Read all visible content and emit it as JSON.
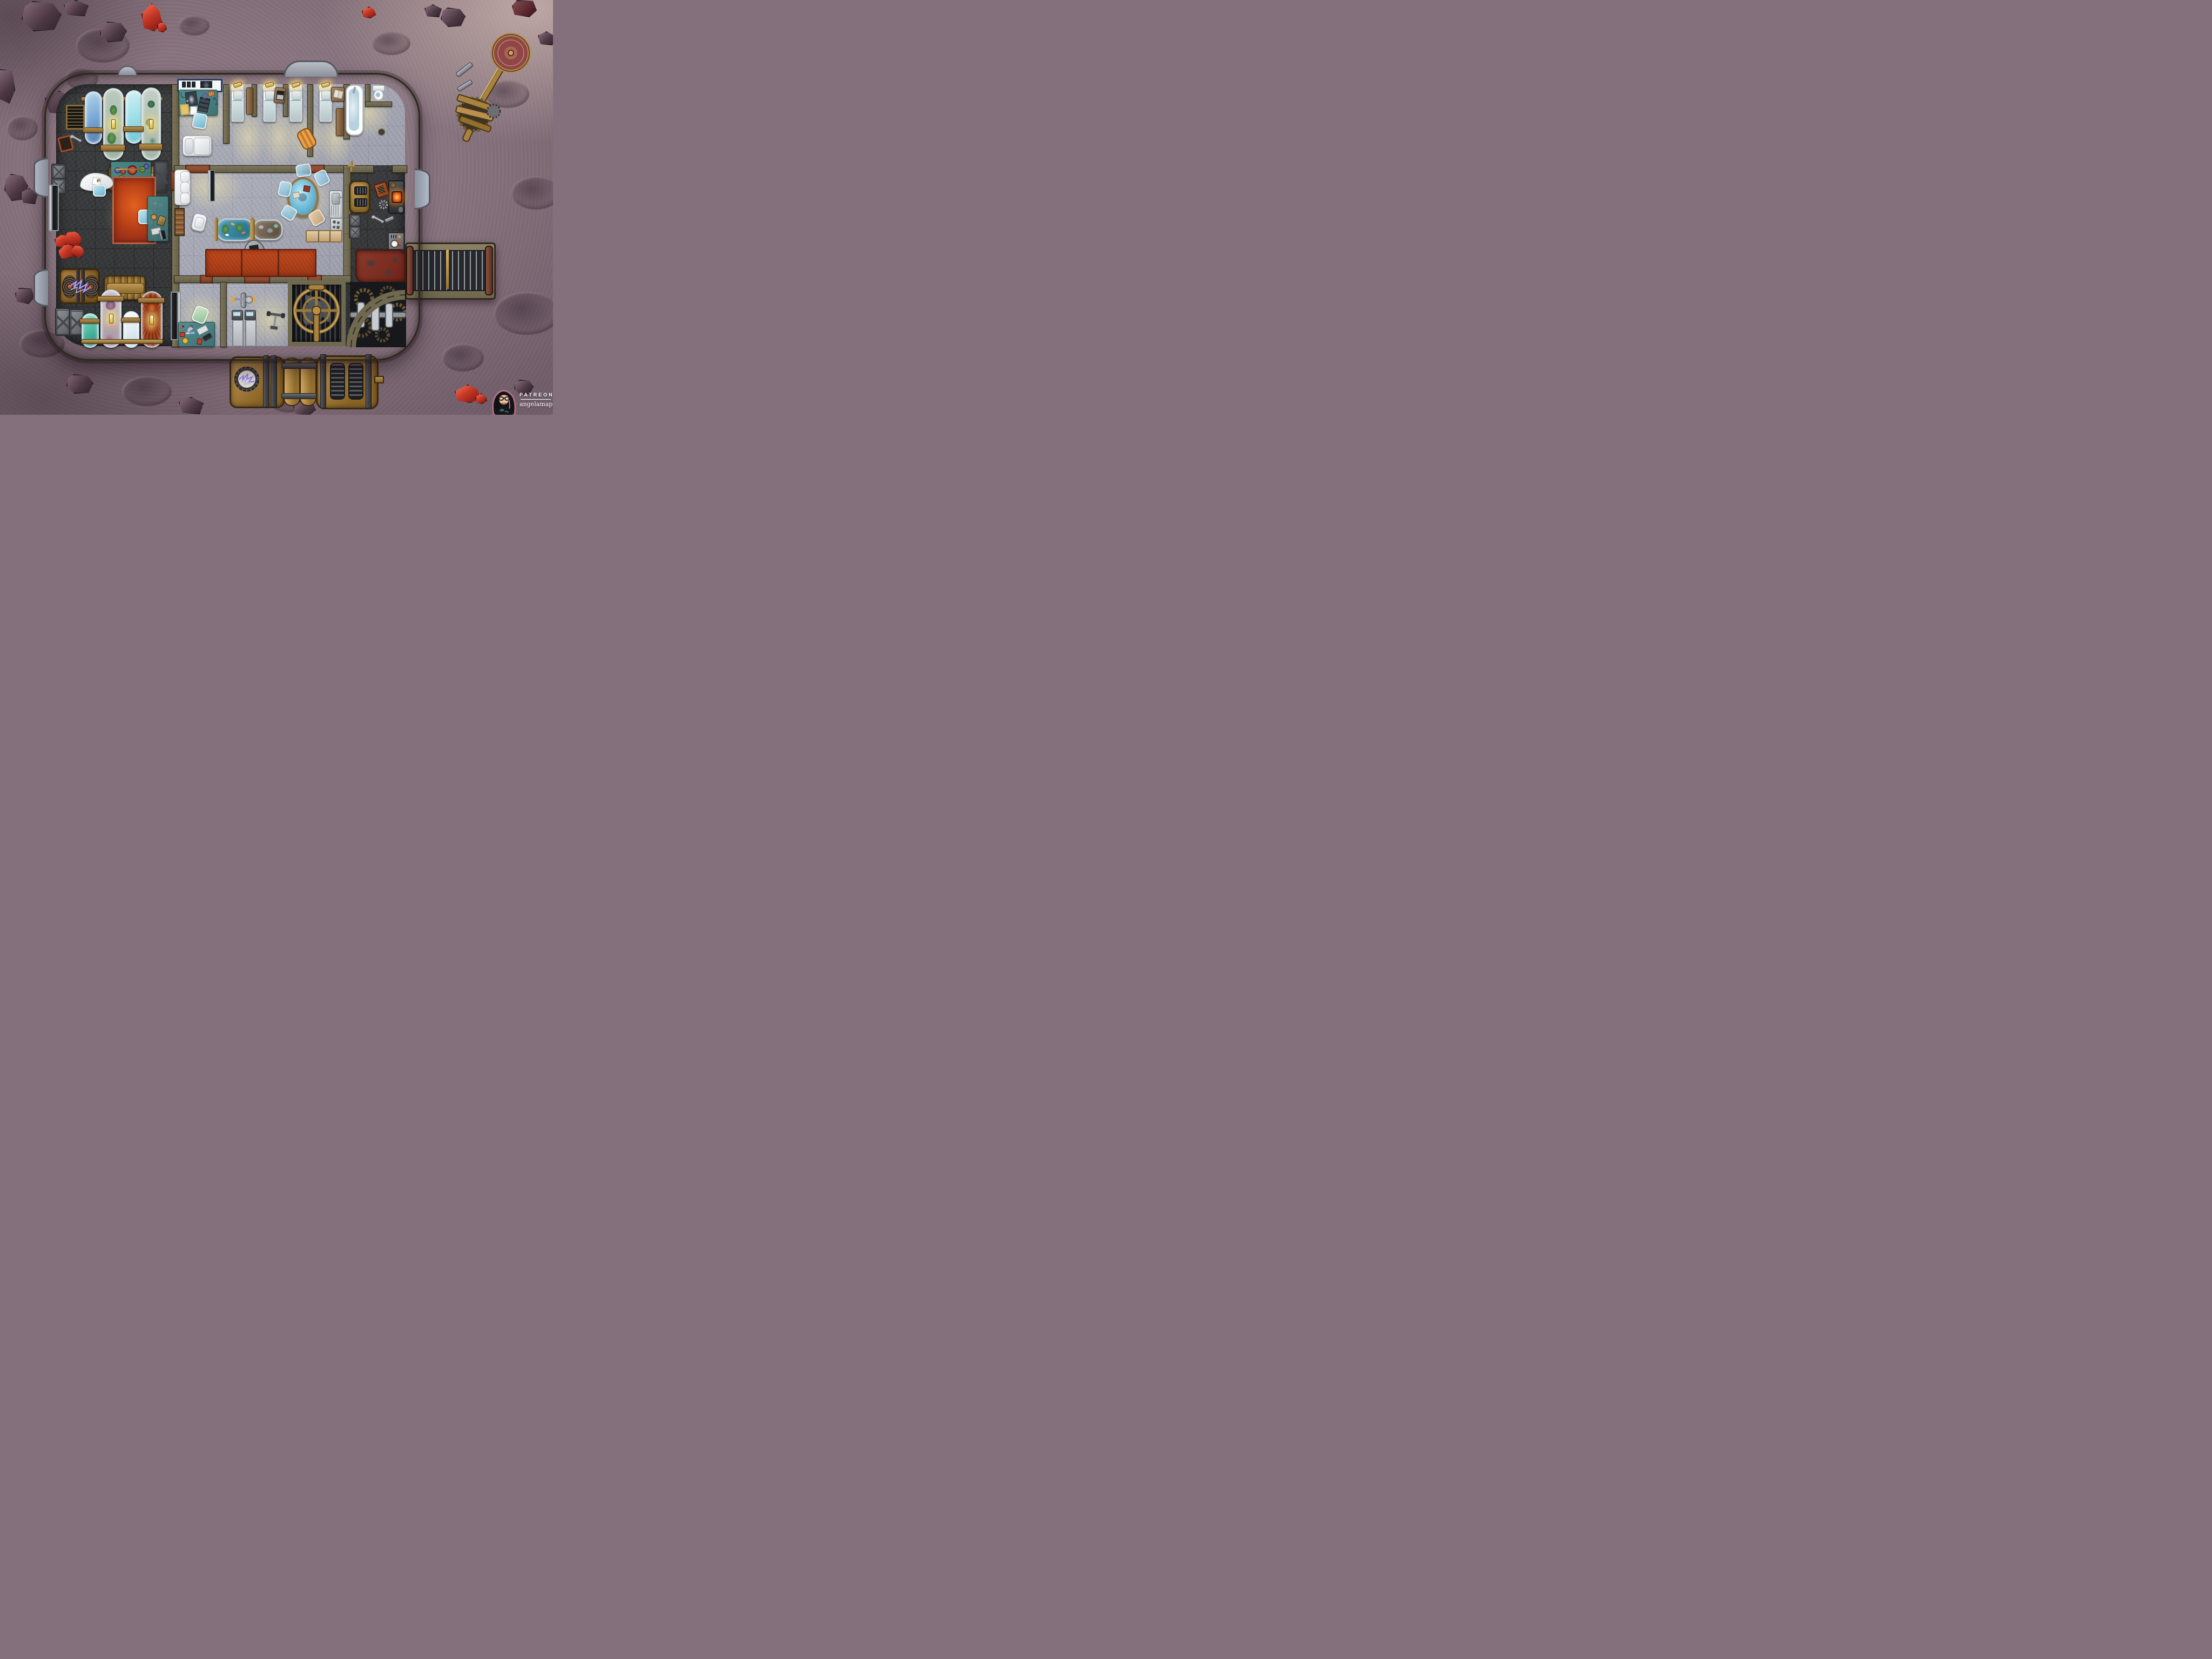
{
  "attribution": {
    "platform_label": "PATREON",
    "creator_handle": "angelamaps",
    "avatar_description": "illustrated woman, long black hair with pink streaks, glasses, black t-shirt, pink outline"
  },
  "palette": {
    "moon": "#9a8590",
    "moon_dark": "#6d5b67",
    "moon_light": "#e9d2c6",
    "wall": "#7b745a",
    "wall_dark": "#322d20",
    "floor_dark": "#3a3c3d",
    "floor_light": "#a7a9b4",
    "brass": "#a8823f",
    "brass_light": "#caa35e",
    "brass_dark": "#4a3413",
    "teal_desk": "#44807f",
    "rug_red": "#c04a1f",
    "rug_worn": "#7e2f23",
    "door_mat": "#8d4a33",
    "glow": "#f6e9b5",
    "water_blue": "#7fb2d9",
    "tank_cyan": "#a9e2ea",
    "tank_teal": "#43b09a",
    "tank_white": "#e8f0f6",
    "tank_red": "#a33b25",
    "tank_purple": "#a58ba0",
    "plant_green": "#4e8f4e",
    "glass_blue": "#9fd4e6",
    "metal": "#8e9196",
    "dark_metal": "#2c2e32",
    "crystal_red": "#c63826",
    "electric_purple": "#8f7bff"
  },
  "map": {
    "style": "top-down steampunk moon-base battle map on cratered dusty purple lunar terrain",
    "grid": "square battle grid, faint lines over all floors",
    "rooms": [
      {
        "id": "specimen-hall",
        "name": "Specimen hall (dark west wing)",
        "floor": "dark charcoal plating",
        "objects": [
          "wall specimen tank - blue water",
          "wall specimen tank - vine specimen with glow lamp",
          "wall specimen tank - cyan fluid",
          "wall specimen tank - rose specimen with glow lamp",
          "brass supply pipe",
          "wall vent grate",
          "wall clock",
          "wrench",
          "stacked metal crates",
          "brass radiator (upper)",
          "alchemy workbench with linked red/green/blue flasks",
          "dark reinforced crate",
          "red area rug",
          "desk chair (teal)",
          "curved reception desk with charts",
          "wall-mounted monitor",
          "pile of red crystal specimens",
          "tesla-coil generator crate with purple arcs",
          "brass radiator (lower)",
          "floor specimen tank - teal fluid",
          "floor specimen tank - coral specimen with glow lamp",
          "floor specimen tank - pale fluid",
          "floor specimen tank - anemone specimen with glow lamp",
          "mineral analysis desk with rocks, scale, keyboard and monitor",
          "wall display facing lab"
        ]
      },
      {
        "id": "medical-bay",
        "name": "Medical bay",
        "floor": "light grey plating",
        "objects": [
          "x-ray lightbox panel",
          "physician desk with chest x-ray, film strips, stethoscope, clipboard, prescription pad, pill packet, magnifier and spectacles",
          "blue desk chair",
          "patient exam bed"
        ]
      },
      {
        "id": "dormitory",
        "name": "Dormitory",
        "floor": "light grey plating",
        "objects": [
          "bed with reading lamp x4",
          "nightstand with laptop",
          "nightstand with open book",
          "tall locker x2",
          "duffel bag",
          "bed partition walls"
        ]
      },
      {
        "id": "bathroom",
        "name": "Bathroom",
        "floor": "light grey plating",
        "objects": [
          "filled bathtub",
          "toilet",
          "wall valve",
          "floor drain"
        ]
      },
      {
        "id": "common-room",
        "name": "Common room",
        "floor": "light grey plating",
        "objects": [
          "white sofa",
          "flat-screen TV",
          "bookshelf",
          "white armchair",
          "koi aquarium on brass stands",
          "terrarium on brass stand",
          "kidney desk with laptop",
          "desk chair (tan)",
          "round glass table with two books",
          "glass chair x4",
          "wooden chair",
          "red rug panels x3"
        ]
      },
      {
        "id": "kitchen",
        "name": "Kitchenette",
        "floor": "light grey plating",
        "objects": [
          "sink unit with drainboard",
          "stove top",
          "tan counter cabinets"
        ]
      },
      {
        "id": "workshop",
        "name": "Workshop (dark east wing)",
        "floor": "dark charcoal plating",
        "objects": [
          "brass boiler with vents",
          "red toolbox",
          "forge furnace with ember glow",
          "spare gear",
          "wrench",
          "metal bar",
          "metal crates",
          "control panel with gauge and buttons",
          "worn blood-stained rug",
          "green pipe tool"
        ]
      },
      {
        "id": "science-lab",
        "name": "Science lab",
        "floor": "light grey plating",
        "objects": [
          "lab bench with microscope, monitor, keyboard, molecule models and instruments",
          "green lab chair",
          "wall display"
        ]
      },
      {
        "id": "gym",
        "name": "Gym",
        "floor": "light grey plating",
        "objects": [
          "exercise bike",
          "treadmill x2",
          "barbell"
        ]
      },
      {
        "id": "ventilation-room",
        "name": "Ventilation room",
        "floor": "gearworks pit",
        "objects": [
          "giant caged brass fan",
          "drive pipe",
          "gear works beneath grill"
        ]
      },
      {
        "id": "engine-room",
        "name": "Engine room",
        "floor": "gearworks pit",
        "objects": [
          "curved bulkhead",
          "gear train",
          "crankshaft with steel pistons"
        ]
      }
    ],
    "exterior_features": [
      "satellite dish array on geared mount",
      "two loose metal bolts",
      "conveyor belt from east wall",
      "external generator: porthole unit with electric arc, twin brass cylinders, vented condenser, outlet pipe",
      "observation dome - top wall",
      "observation dome - top-left wall",
      "observation dome x2 - left wall",
      "observation dome - right wall",
      "scattered purple boulders",
      "red crystal formations x3",
      "impact craters"
    ]
  }
}
